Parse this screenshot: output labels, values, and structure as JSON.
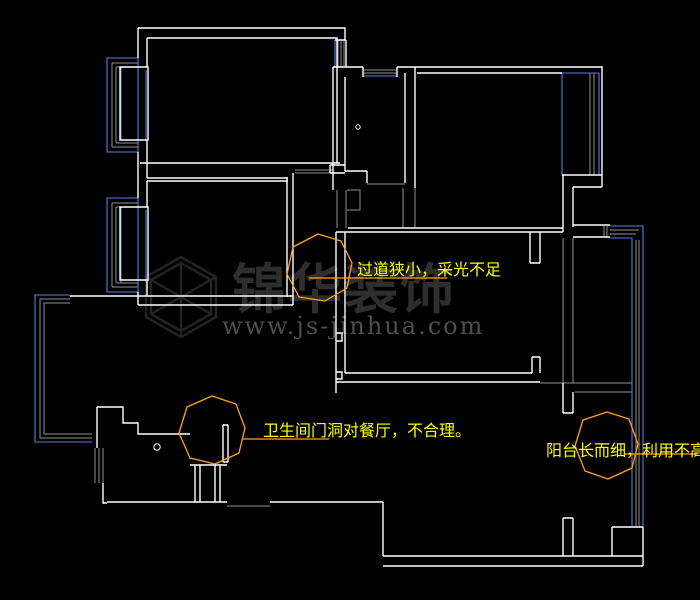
{
  "canvas": {
    "width": 700,
    "height": 600,
    "type": "cad-floor-plan"
  },
  "colors": {
    "bg": "#000000",
    "wall": "#ffffff",
    "window": "#5b7ce6",
    "opening": "#8f8f8f",
    "anno": "#ffff00",
    "cloud": "#ffa31a",
    "wm-logo": "#242424",
    "wm-brand": "#2e2e2e",
    "wm-url": "#4e4e4e"
  },
  "annotations": [
    {
      "id": "corridor",
      "text": "过道狭小，采光不足"
    },
    {
      "id": "bathroom-door",
      "text": "卫生间门洞对餐厅，不合理。"
    },
    {
      "id": "balcony",
      "text": "阳台长而细，利用不高"
    }
  ],
  "watermark": {
    "brand": "锦华装饰",
    "url": "www.js-jinhua.com"
  }
}
